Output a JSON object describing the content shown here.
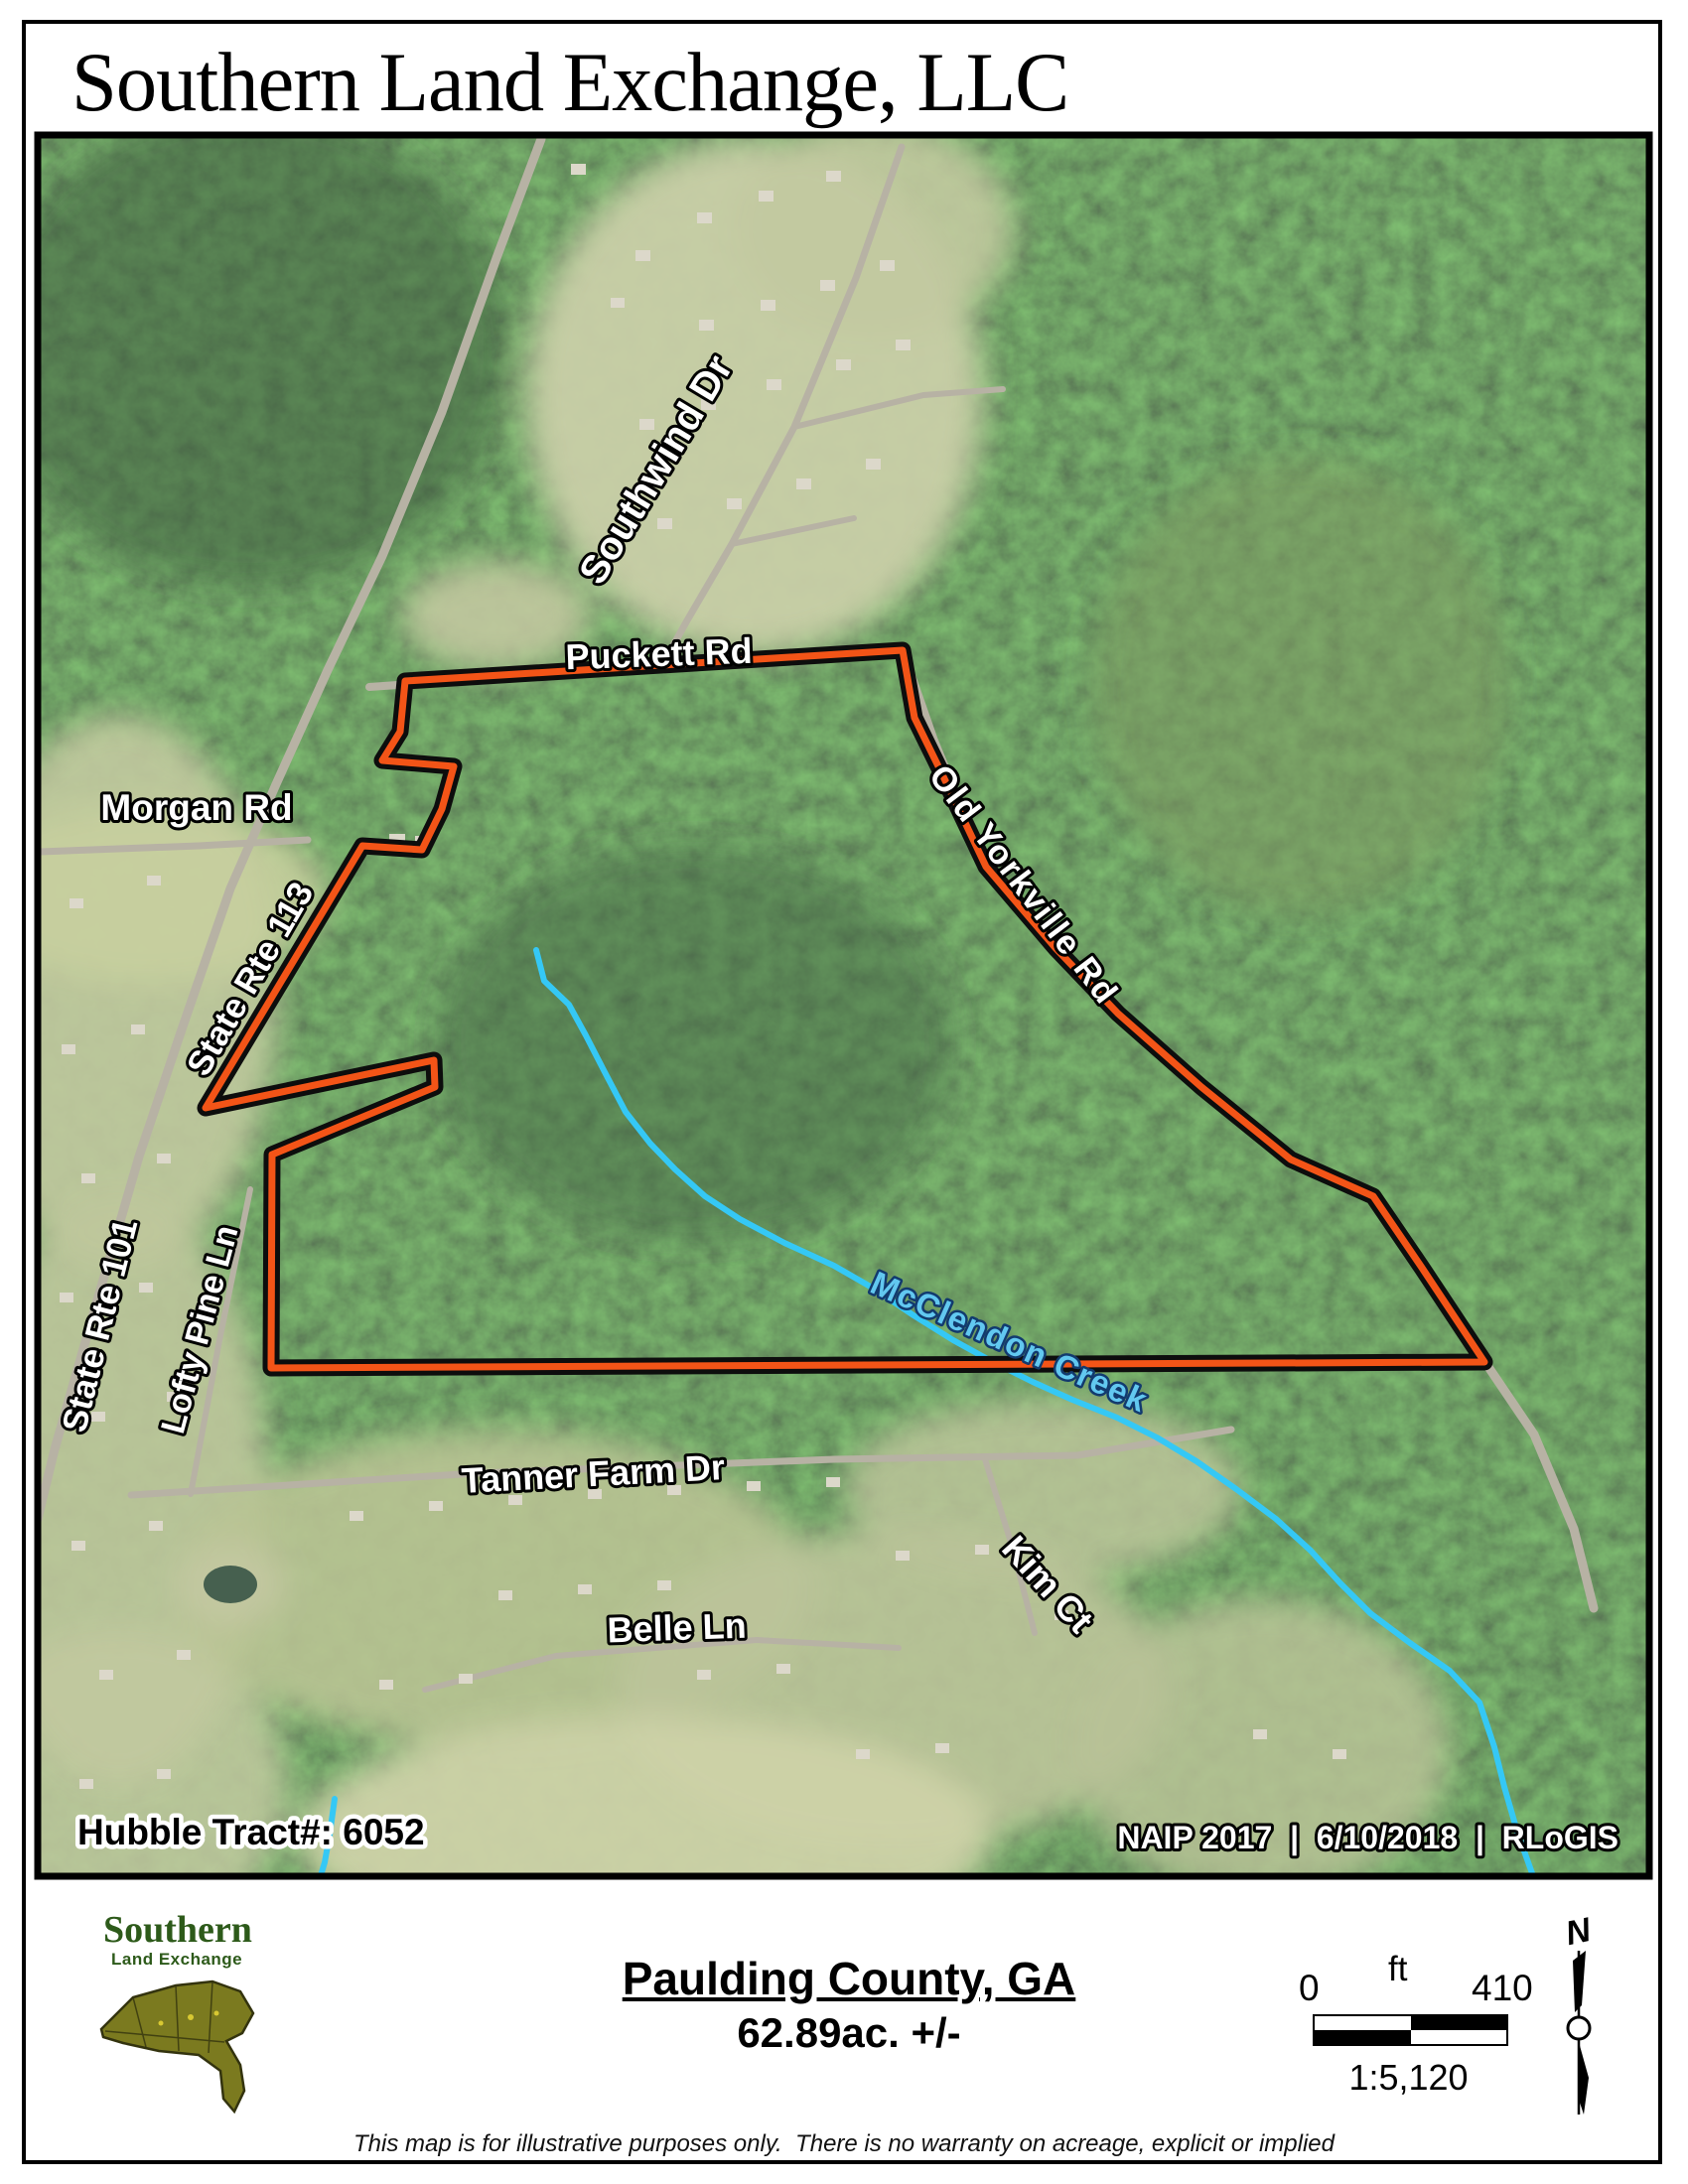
{
  "page": {
    "title": "Southern Land Exchange, LLC"
  },
  "map": {
    "road_labels": {
      "southwind": "Southwind Dr",
      "puckett": "Puckett Rd",
      "morgan": "Morgan Rd",
      "rte113": "State Rte 113",
      "old_yorkville": "Old Yorkville Rd",
      "rte101": "State Rte 101",
      "lofty_pine": "Lofty Pine Ln",
      "tanner_farm": "Tanner Farm Dr",
      "belle": "Belle Ln",
      "kim": "Kim Ct"
    },
    "creek_label": "McClendon Creek",
    "tract_label": "Hubble Tract#: 6052",
    "credits": "NAIP 2017  |  6/10/2018  |  RLoGIS",
    "boundary_points": "408,686 909,655 921,723 948,778 993,873 1063,955 1126,1021 1210,1095 1300,1168 1383,1205 1432,1277 1495,1372 273,1378 274,1163 438,1095 437,1068 207,1116 365,852 425,856 445,815 457,772 385,766 403,737",
    "creek_path": "M540,957 L548,988 L573,1012 L590,1043 L608,1078 L630,1120 L655,1152 L680,1178 L710,1205 L745,1228 L790,1252 L840,1275 L880,1298 L920,1325 L960,1350 L1000,1372 L1040,1392 L1080,1410 L1125,1428 L1165,1448 L1205,1472 L1245,1500 L1285,1530 L1320,1562 L1350,1595 L1380,1625 L1420,1655 L1460,1683 L1490,1715 L1505,1760 L1515,1800 L1528,1845 L1543,1887",
    "creek_stub_path": "M337,1812 L332,1848 L327,1876 L321,1896",
    "colors": {
      "boundary_orange": "#f35417",
      "creek_blue": "#35c8f5"
    }
  },
  "footer": {
    "logo_line1": "Southern",
    "logo_line2": "Land Exchange",
    "county": "Paulding County, GA",
    "acreage": "62.89ac. +/-",
    "scale_left": "0",
    "scale_unit": "ft",
    "scale_right": "410",
    "scale_ratio": "1:5,120",
    "north_label": "N",
    "disclaimer": "This map is for illustrative purposes only.  There is no warranty on acreage, explicit or implied"
  }
}
